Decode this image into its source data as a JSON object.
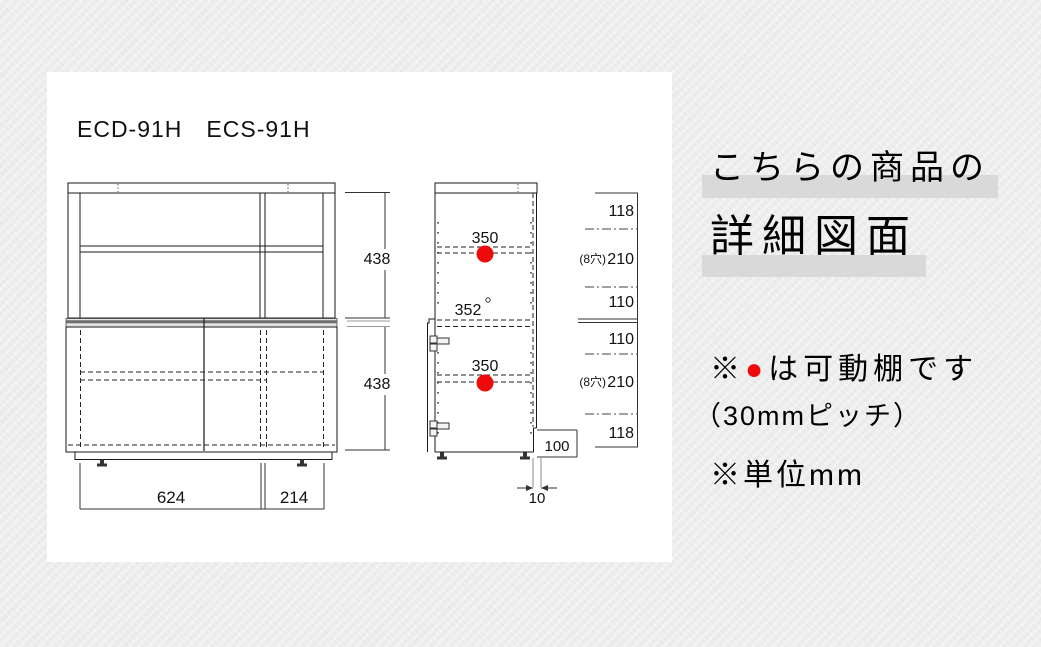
{
  "title": {
    "models": "ECD-91H　ECS-91H"
  },
  "drawing": {
    "front": {
      "upper_height": "438",
      "lower_height": "438",
      "bottom_width_left": "624",
      "bottom_width_right": "214"
    },
    "side": {
      "upper_shelf": "350",
      "mid_depth": "352",
      "lower_shelf": "350",
      "notch_height": "100",
      "notch_depth": "10",
      "holes_upper": "(8穴)",
      "holes_lower": "(8穴)",
      "heights": [
        "118",
        "210",
        "110",
        "110",
        "210",
        "118"
      ]
    }
  },
  "info": {
    "heading_line1": "こちらの商品の",
    "heading_line2": "詳細図面",
    "note_shelf_prefix": "※",
    "note_shelf_bullet": "●",
    "note_shelf_text": "は可動棚です",
    "note_pitch": "（30mmピッチ）",
    "note_unit": "※単位mm"
  },
  "colors": {
    "background": "#ecedec",
    "panel": "#ffffff",
    "line": "#1a1a1a",
    "highlight": "#d9d9d9",
    "text": "#4b4b4b",
    "movable_shelf_red": "#ee0a0a"
  }
}
